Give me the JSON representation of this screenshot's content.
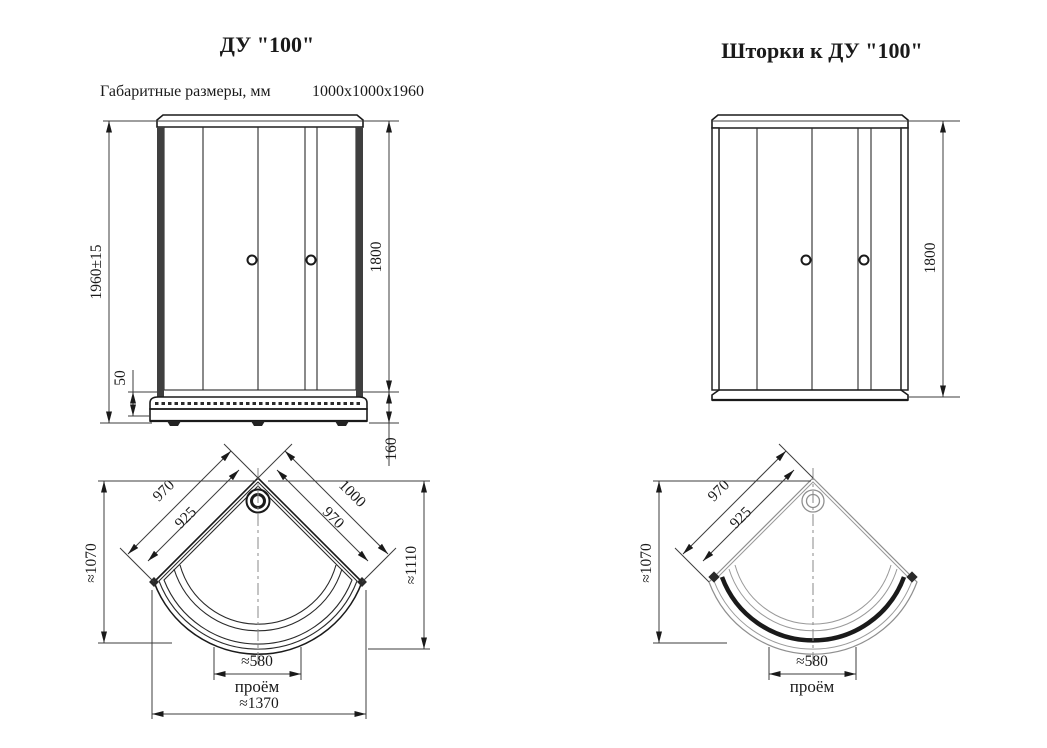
{
  "colors": {
    "line": "#1a1a1a",
    "dim_line": "#3c3c3c",
    "reference_line": "#8f8f8f"
  },
  "left_drawing": {
    "title": "ДУ \"100\"",
    "subtitle": {
      "label": "Габаритные размеры, мм",
      "value": "1000x1000x1960"
    },
    "front_view": {
      "overall_height": "1960±15",
      "tray_lip_height": "50",
      "door_height": "1800",
      "tray_height": "160"
    },
    "plan_view": {
      "back_edge_outer_left": "970",
      "back_edge_inner_left": "925",
      "back_edge_outer_right": "1000",
      "back_edge_inner_right": "970",
      "depth_left": "≈1070",
      "depth_right": "≈1110",
      "opening_width": "≈580",
      "opening_label": "проём",
      "overall_width": "≈1370"
    }
  },
  "right_drawing": {
    "title": "Шторки к ДУ \"100\"",
    "front_view": {
      "door_height": "1800"
    },
    "plan_view": {
      "back_edge_outer_left": "970",
      "back_edge_inner_left": "925",
      "depth_left": "≈1070",
      "opening_width": "≈580",
      "opening_label": "проём"
    }
  }
}
